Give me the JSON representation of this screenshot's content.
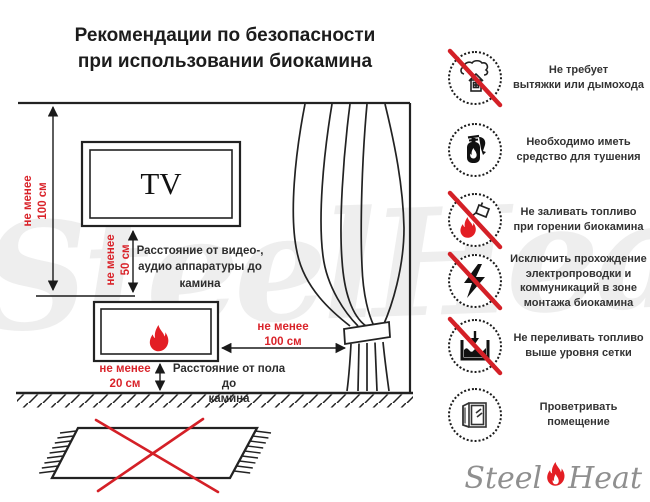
{
  "title": [
    "Рекомендации по безопасности",
    "при использовании биокамина"
  ],
  "diagram": {
    "tv_label": "TV",
    "dim_ceiling_label": [
      "не менее",
      "100 см"
    ],
    "dim_tv_label": [
      "не менее",
      "50 см"
    ],
    "dim_tv_caption": [
      "Расстояние от видео-,",
      "аудио аппаратуры до",
      "камина"
    ],
    "dim_floor_label": [
      "не менее",
      "20 см"
    ],
    "dim_floor_caption": [
      "Расстояние от пола до",
      "камина"
    ],
    "dim_curtain_label": [
      "не менее",
      "100 см"
    ]
  },
  "rules": [
    {
      "icon": "no-chimney",
      "crossed": true,
      "lines": [
        "Не требует",
        "вытяжки или дымохода"
      ]
    },
    {
      "icon": "extinguisher",
      "crossed": false,
      "lines": [
        "Необходимо иметь",
        "средство для тушения"
      ]
    },
    {
      "icon": "no-refuel",
      "crossed": true,
      "lines": [
        "Не заливать топливо",
        "при горении биокамина"
      ]
    },
    {
      "icon": "no-wiring",
      "crossed": true,
      "lines": [
        "Исключить прохождение",
        "электропроводки и",
        "коммуникаций в зоне",
        "монтажа биокамина"
      ]
    },
    {
      "icon": "no-overfill",
      "crossed": true,
      "lines": [
        "Не переливать топливо",
        "выше уровня сетки"
      ]
    },
    {
      "icon": "ventilate",
      "crossed": false,
      "lines": [
        "Проветривать",
        "помещение"
      ]
    }
  ],
  "watermark": "SteelHeat",
  "logo": {
    "part1": "Steel",
    "part2": "Heat"
  },
  "colors": {
    "accent_red": "#d9232a",
    "flame_red": "#e31e24",
    "line": "#222222"
  }
}
